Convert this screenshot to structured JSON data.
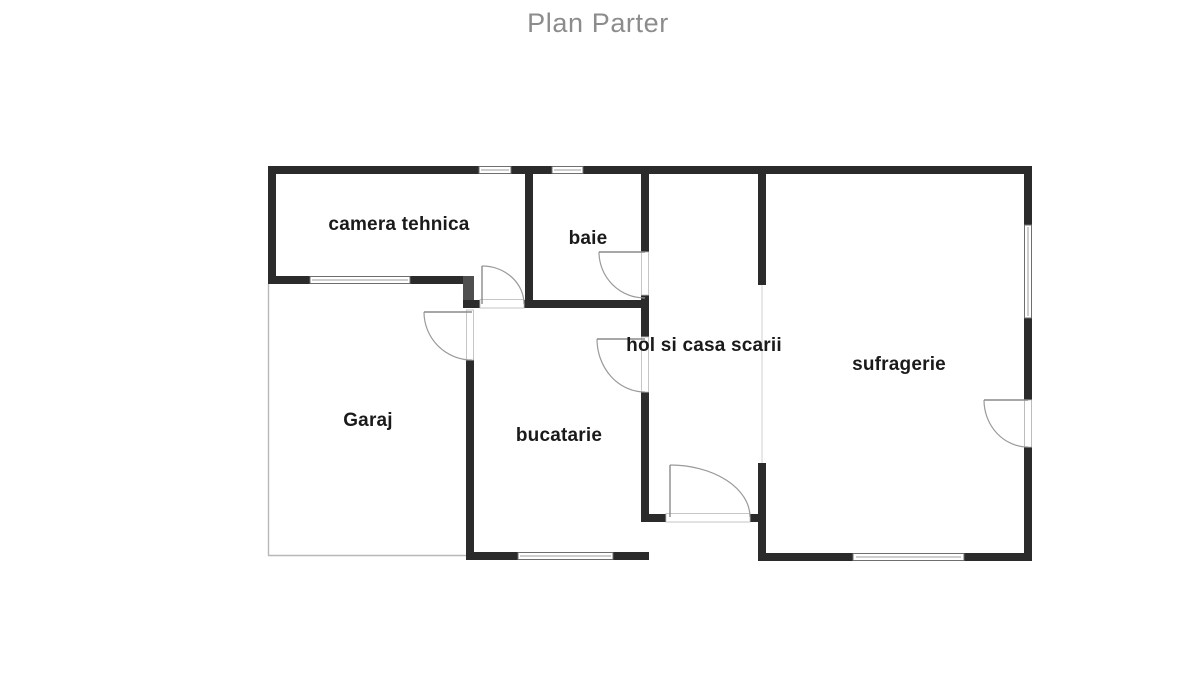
{
  "floor_plan": {
    "title": "Plan Parter",
    "rooms": [
      {
        "id": "camera-tehnica",
        "label": "camera tehnica"
      },
      {
        "id": "baie",
        "label": "baie"
      },
      {
        "id": "hol-si-casa-scarii",
        "label": "hol si casa scarii"
      },
      {
        "id": "sufragerie",
        "label": "sufragerie"
      },
      {
        "id": "garaj",
        "label": "Garaj"
      },
      {
        "id": "bucatarie",
        "label": "bucatarie"
      }
    ],
    "colors": {
      "background": "#ffffff",
      "wall": "#2b2b2b",
      "title_text": "#8c8c8c",
      "room_text": "#1a1a1a",
      "door_arc": "#9a9a9a",
      "garage_outline": "#b8b8b8"
    }
  }
}
